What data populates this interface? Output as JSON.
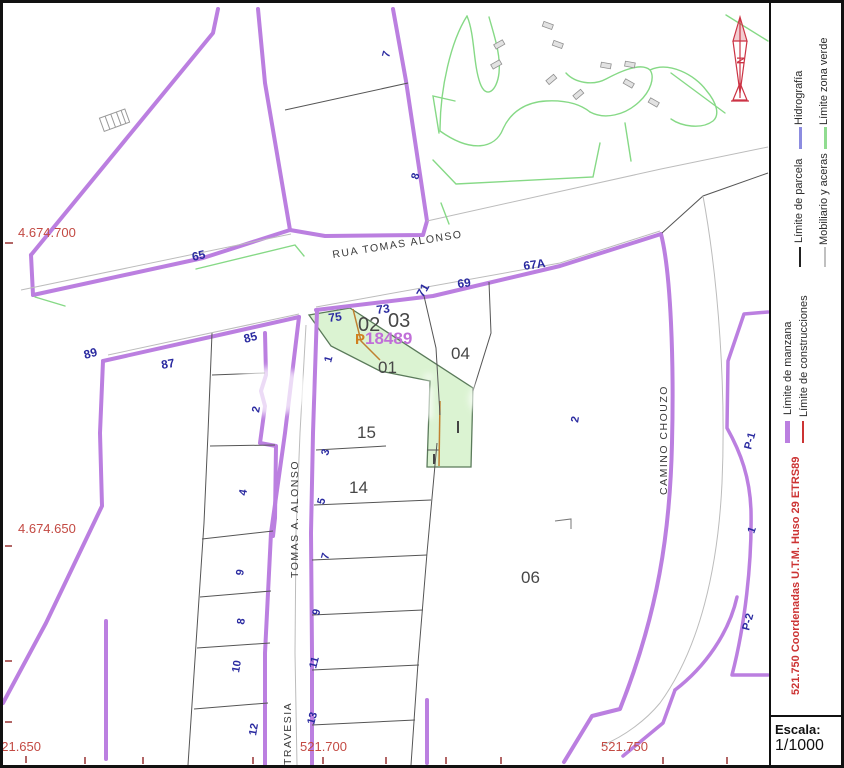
{
  "map": {
    "street_labels": [
      "RUA TOMAS ALONSO",
      "TOMAS A. ALONSO",
      "TRAVESIA",
      "CAMINO CHOUZO"
    ],
    "blue_labels": [
      "65",
      "7",
      "8",
      "75",
      "73",
      "71",
      "69",
      "67A",
      "89",
      "87",
      "85",
      "2",
      "4",
      "9",
      "8",
      "10",
      "12",
      "1",
      "3",
      "5",
      "7",
      "9",
      "11",
      "13",
      "2",
      "P-1",
      "1",
      "P-2"
    ],
    "block_labels": [
      "02",
      "03",
      "04",
      "01",
      "15",
      "14",
      "06"
    ],
    "coord_labels": [
      "4.674.700",
      "4.674.650",
      "521.650",
      "521.700",
      "521.750"
    ],
    "highlight": {
      "prefix": "P",
      "digits": "18489"
    },
    "watermark_text": "evi",
    "north_letter": "N"
  },
  "legend": {
    "items": [
      {
        "label": "Límite de parcela",
        "color": "#222222"
      },
      {
        "label": "Mobiliario y aceras",
        "color": "#c0c0c0"
      },
      {
        "label": "Hidrografía",
        "color": "#8c8ce0"
      },
      {
        "label": "Límite zona verde",
        "color": "#90dc90"
      },
      {
        "label": "Límite de manzana",
        "color": "#bb7fe0"
      },
      {
        "label": "Límite de construcciones",
        "color": "#cc3333"
      }
    ],
    "crs_note": "521.750 Coordenadas U.T.M. Huso 29 ETRS89"
  },
  "scale": {
    "title": "Escala:",
    "value": "1/1000"
  },
  "colors": {
    "manzana_purple": "#bb7fe0",
    "parcela_black": "#555555",
    "construcciones_red": "#cc3333",
    "zona_verde_green": "#86d986",
    "highlight_fill": "#dbf3d2",
    "coords_red": "#c34a43",
    "parcel_blue": "#2a2aa0"
  }
}
